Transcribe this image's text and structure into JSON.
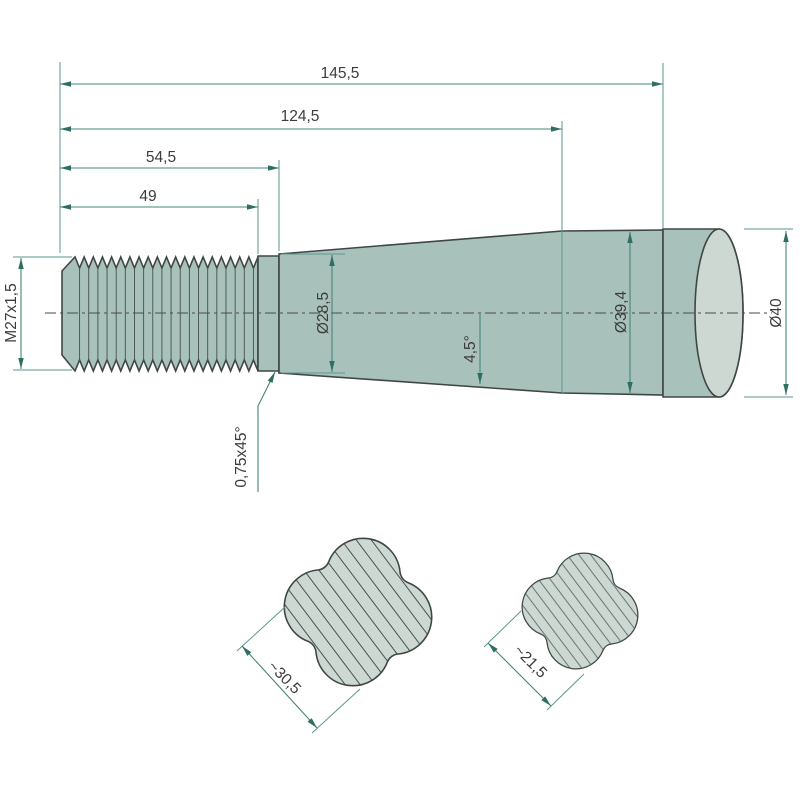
{
  "drawing": {
    "type": "technical-drawing",
    "subject": "conical tine / spike with metric thread, side view with two hatched clover cross-sections",
    "labels": {
      "total_length": "145,5",
      "length_to_cylinder": "124,5",
      "thread_section_length": "54,5",
      "thread_length": "49",
      "thread_spec": "M27x1,5",
      "taper_start_diameter": "Ø28,5",
      "cylinder_diameter": "Ø39,4",
      "end_diameter": "Ø40",
      "taper_angle": "4,5°",
      "chamfer": "0,75x45°",
      "cross_section_large": "~30,5",
      "cross_section_small": "~21,5"
    },
    "colors": {
      "body": "#a8c2bb",
      "face": "#cdd8d2",
      "outline": "#3f4745",
      "dimension": "#44847a",
      "arrow": "#2f6e63",
      "text": "#3c3c3c",
      "background": "#ffffff"
    }
  }
}
